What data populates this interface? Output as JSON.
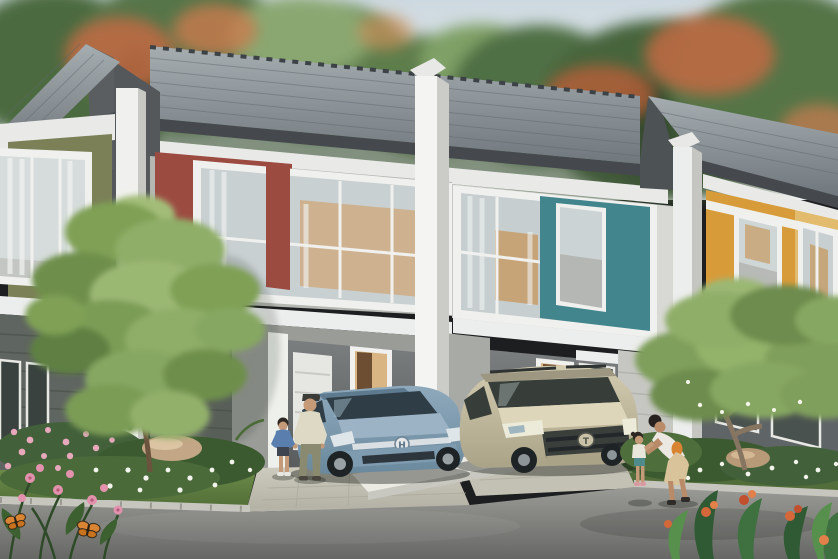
{
  "meta": {
    "title": "Row of modern two-storey townhouses - daytime exterior rendering",
    "type": "architectural visualization",
    "view": "street-level, row recedes to the right"
  },
  "palette": {
    "sky_top": "#cdd9e0",
    "sky_bottom": "#f3f6f6",
    "foliage_dark": "#3f5a36",
    "foliage_mid": "#5b7a4a",
    "foliage_light": "#7d9b60",
    "blossom_orange": "#c26a43",
    "roof_light": "#a6adb1",
    "roof_dark": "#70787d",
    "fascia_dark": "#45494d",
    "trim_white": "#f0f1ee",
    "wall_light": "#c2c4c0",
    "wall_mid": "#9a9c98",
    "siding_dark": "#5f6560",
    "carport_dark": "#595c5d",
    "door_warm": "#d9b584",
    "door_leaf": "#6d4e33",
    "glass_dark": "#39444a",
    "glass_light": "#c9d0d2",
    "lawn_light": "#6b8a48",
    "lawn_dark": "#4e6b36",
    "drive_concrete": "#c9c6ba",
    "curb_white": "#ecebe3",
    "road_light": "#9a9b96",
    "road_dark": "#676865",
    "rock_tan": "#c2a685",
    "mpv_light": "#8fa9bc",
    "mpv_dark": "#6a899d",
    "suv_light": "#d2cbb0",
    "suv_dark": "#aaa388",
    "flower_pink": "#e292ac",
    "flower_white": "#f2f3ea",
    "butterfly_orange": "#d88433",
    "skin": "#c49a78"
  },
  "scene": {
    "background": {
      "sky": "pale hazy daytime sky",
      "trees": "dense tropical canopy with orange flame-tree blossoms"
    },
    "houses": [
      {
        "name": "house-far-left",
        "accent_name": "olive-green",
        "accent_color": "#7b8057",
        "floors": 2,
        "lower_facade": "dark grey horizontal siding"
      },
      {
        "name": "house-center-left",
        "accent_name": "maroon-red",
        "accent_color": "#9c4b41",
        "floors": 2,
        "features": [
          "large upper picture window",
          "carport with white panel door",
          "open warm-lit entry door"
        ]
      },
      {
        "name": "house-center-right",
        "accent_name": "teal",
        "accent_color": "#42858d",
        "floors": 2,
        "features": [
          "large upper picture window with teal panel",
          "entry door",
          "ground-floor window"
        ]
      },
      {
        "name": "house-far-right",
        "accent_name": "yellow-ochre",
        "accent_color": "#d79b3a",
        "floors": 2,
        "features": [
          "white rail above upper windows"
        ]
      }
    ],
    "vehicles": [
      {
        "name": "steel-blue-mpv",
        "badge": "H",
        "color": "#7e9bb0",
        "location": "driveway of maroon-accent house"
      },
      {
        "name": "champagne-suv",
        "badge": "T",
        "color": "#c8c1a5",
        "location": "driveway of teal-accent house",
        "detail": "dark roof rails"
      }
    ],
    "people": [
      {
        "name": "father",
        "outfit": "cream shirt, olive trousers, dark cap",
        "position": "standing beside MPV with toddler"
      },
      {
        "name": "toddler-boy",
        "outfit": "blue t-shirt, dark shorts",
        "position": "left of father"
      },
      {
        "name": "bearded-man",
        "outfit": "grey t-shirt",
        "position": "standing behind SUV"
      },
      {
        "name": "mother",
        "outfit": "white sleeveless top, beige skirt, orange bag",
        "position": "bending toward little girl at right"
      },
      {
        "name": "little-girl",
        "outfit": "white top, teal shorts",
        "position": "facing mother on right path"
      }
    ],
    "landscape": {
      "left_garden": [
        "green lawn",
        "pink and white flower bed",
        "sandstone boulder",
        "ornamental tree in front of facade"
      ],
      "right_garden": [
        "white flower bed",
        "boulder",
        "frangipani tree",
        "leafy shrubs"
      ],
      "foreground": [
        "grey asphalt road",
        "white kerb stones",
        "white kerb wedge between driveways",
        "pink flowers with two orange butterflies",
        "orange canna flowers lower right"
      ]
    }
  }
}
